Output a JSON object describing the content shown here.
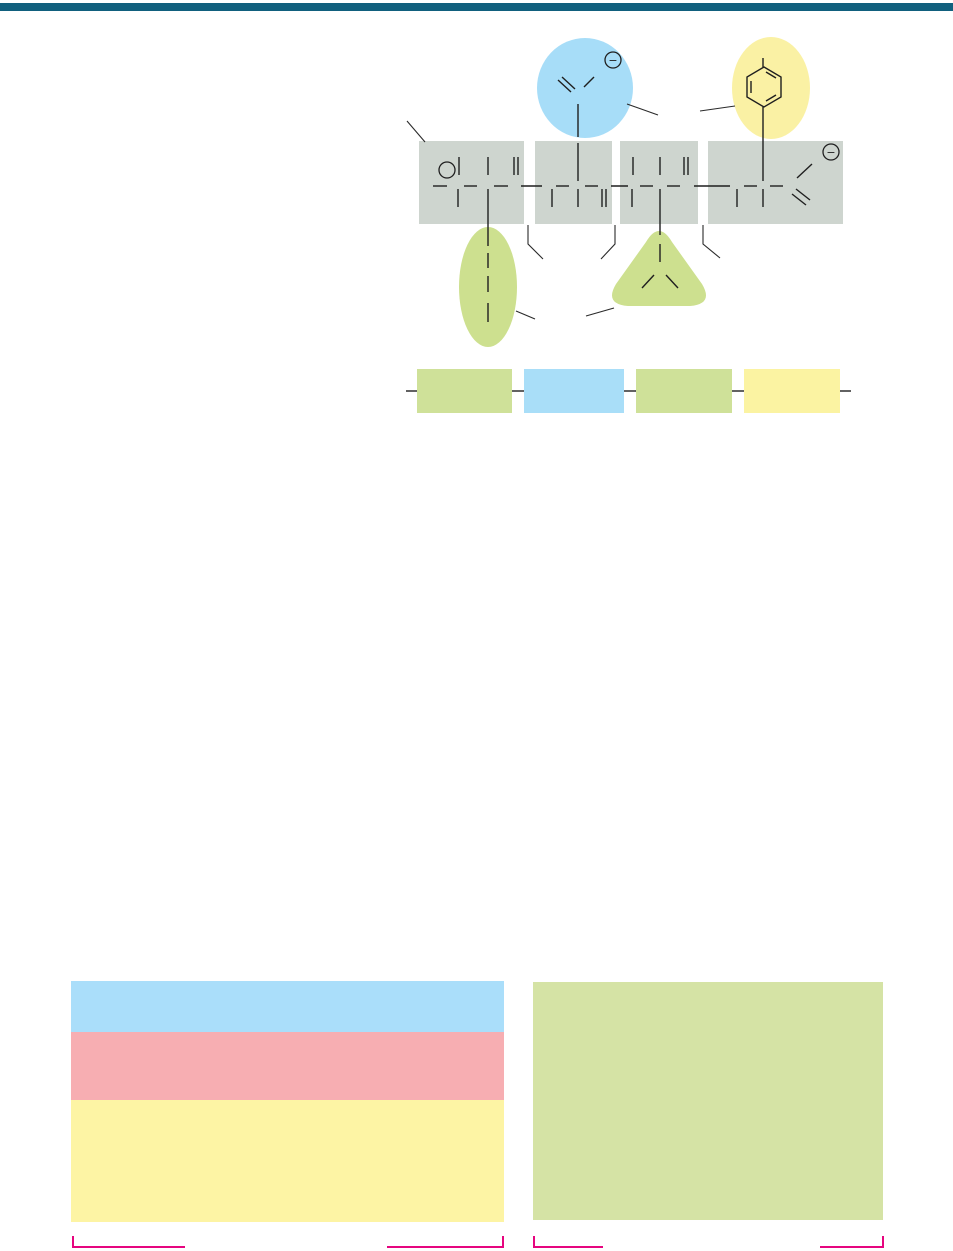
{
  "page": {
    "background": "#ffffff",
    "top_rule_color": "#11607e"
  },
  "colors": {
    "residue_box": "#ced5cf",
    "highlight_blue": "#a7ddf8",
    "highlight_yellow": "#faf1a4",
    "highlight_green": "#cde08f",
    "schematic_green": "#cfe199",
    "schematic_blue": "#a9def8",
    "schematic_yellow": "#fbf3a2",
    "panel_blue": "#aadefa",
    "panel_pink": "#f7aeb2",
    "panel_yellow": "#fdf4a4",
    "panel_green": "#d5e3a5",
    "bracket_magenta": "#e6057f",
    "bond": "#1f1f1f"
  },
  "figure": {
    "type": "peptide-structural-formula",
    "residues": [
      {
        "index": 1,
        "side_chain_shape": "oval",
        "side_chain_color_key": "highlight_green",
        "side_chain_position": "below"
      },
      {
        "index": 2,
        "side_chain_shape": "circle",
        "side_chain_color_key": "highlight_blue",
        "side_chain_position": "above"
      },
      {
        "index": 3,
        "side_chain_shape": "rounded-triangle",
        "side_chain_color_key": "highlight_green",
        "side_chain_position": "below"
      },
      {
        "index": 4,
        "side_chain_shape": "ellipse-with-benzene-ring",
        "side_chain_color_key": "highlight_yellow",
        "side_chain_position": "above"
      }
    ],
    "charges": {
      "side_chain_carboxylate": "−",
      "c_terminal_carboxylate": "−"
    },
    "schematic_segment_colors": [
      "green",
      "blue",
      "green",
      "yellow"
    ]
  },
  "panels": {
    "left_rows": [
      "blue",
      "pink",
      "yellow"
    ],
    "right": "green"
  }
}
